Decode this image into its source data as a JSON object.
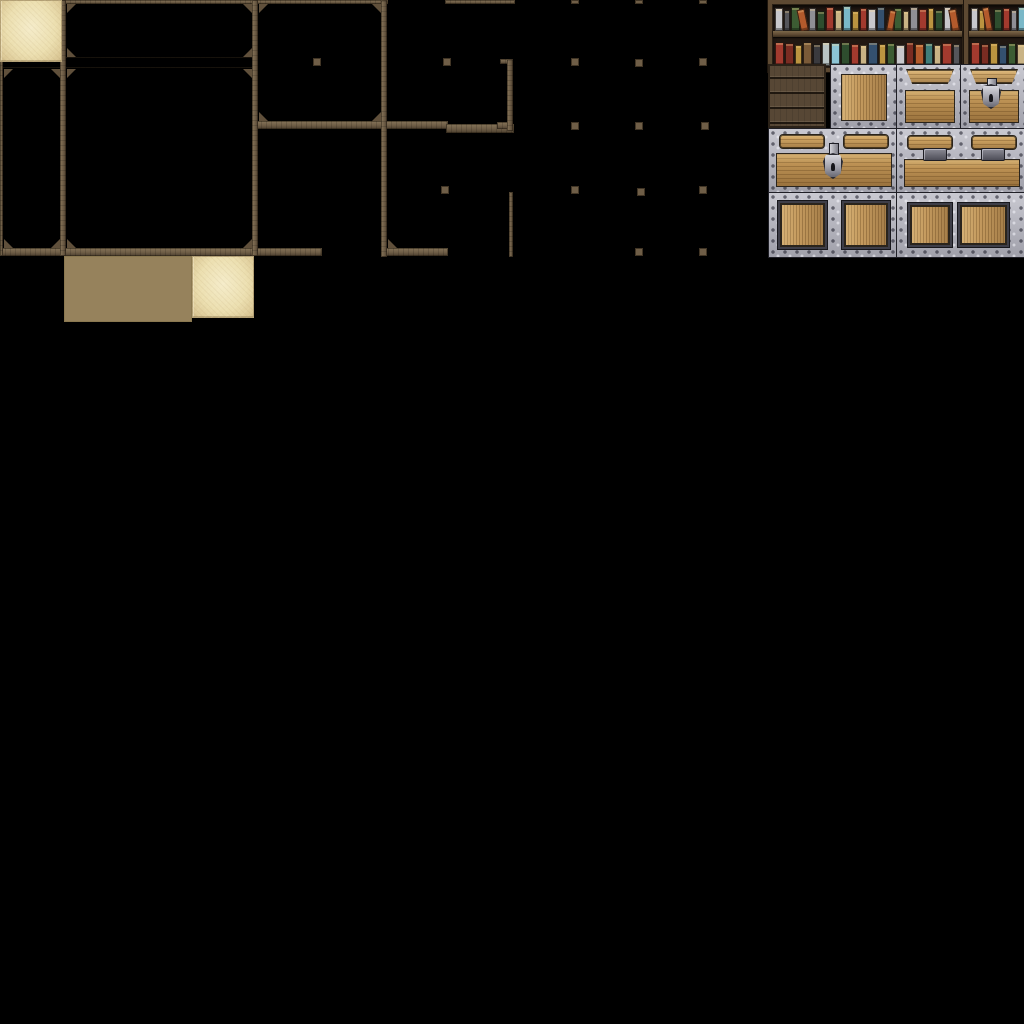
{
  "meta": {
    "asset_type": "rpg-interior-tileset-spritesheet",
    "canvas": {
      "width": 1024,
      "height": 1024,
      "background": "#000000"
    },
    "tile_size": 64,
    "sections": [
      "wood-wall-frames",
      "floor-tiles",
      "furniture-sprites"
    ]
  },
  "palette": {
    "beam_wood": "#6f5e47",
    "beam_wood_light": "#87755a",
    "beam_wood_dark": "#4c3f2f",
    "sand_floor": "#ecdfb0",
    "sand_light": "#f5ecca",
    "sand_shadow": "#ccb786",
    "cobble_stone": "#ecdfae",
    "cobble_grout": "#96825c",
    "shelf_frame": "#5d4932",
    "shelf_backdrop": "#211812",
    "metal_silver": "#b2b2ba",
    "metal_dark": "#3e3e48",
    "metal_outline": "#1f1f26",
    "chest_wood": "#bd9254",
    "chest_wood_light": "#d4ad72",
    "crate_dark_wood": "#574735"
  },
  "tiles_catalog": [
    {
      "name": "wall-frame-cell-small",
      "x": 0,
      "y": 0,
      "w": 64,
      "h": 64
    },
    {
      "name": "wall-frame-cell-wide",
      "x": 64,
      "y": 0,
      "w": 192,
      "h": 64
    },
    {
      "name": "wall-frame-cell-tall",
      "x": 256,
      "y": 0,
      "w": 128,
      "h": 128
    },
    {
      "name": "wall-frame-cell-room",
      "x": 0,
      "y": 64,
      "w": 256,
      "h": 192
    },
    {
      "name": "wall-post-knobs",
      "x": 512,
      "y": 0,
      "w": 256,
      "h": 256
    },
    {
      "name": "sand-floor",
      "x": 0,
      "y": 256,
      "w": 64,
      "h": 64
    },
    {
      "name": "cobblestone-floor",
      "x": 64,
      "y": 256,
      "w": 128,
      "h": 64
    },
    {
      "name": "sand-floor-2",
      "x": 192,
      "y": 256,
      "w": 64,
      "h": 64
    },
    {
      "name": "bookshelf-wide",
      "x": 768,
      "y": 0,
      "w": 192,
      "h": 64
    },
    {
      "name": "bookshelf-small",
      "x": 960,
      "y": 0,
      "w": 64,
      "h": 64
    },
    {
      "name": "dark-plank-crate",
      "x": 768,
      "y": 64,
      "w": 64,
      "h": 64
    },
    {
      "name": "ornate-metal-crate",
      "x": 832,
      "y": 64,
      "w": 64,
      "h": 64
    },
    {
      "name": "chest-top-plain",
      "x": 896,
      "y": 64,
      "w": 64,
      "h": 64
    },
    {
      "name": "chest-top-lock",
      "x": 960,
      "y": 64,
      "w": 64,
      "h": 64
    },
    {
      "name": "chest-front-lock",
      "x": 768,
      "y": 128,
      "w": 128,
      "h": 64
    },
    {
      "name": "chest-front-hinges",
      "x": 896,
      "y": 128,
      "w": 128,
      "h": 64
    },
    {
      "name": "chest-base-panels-a",
      "x": 768,
      "y": 192,
      "w": 128,
      "h": 64
    },
    {
      "name": "chest-base-panels-b",
      "x": 896,
      "y": 192,
      "w": 128,
      "h": 64
    }
  ],
  "wall_frame": {
    "beams": [
      [
        0,
        0,
        388,
        4,
        "h"
      ],
      [
        445,
        0,
        70,
        4,
        "h"
      ],
      [
        0,
        57,
        256,
        11,
        "shelf"
      ],
      [
        256,
        121,
        192,
        8,
        "h"
      ],
      [
        446,
        124,
        68,
        9,
        "h"
      ],
      [
        0,
        248,
        322,
        8,
        "h"
      ],
      [
        383,
        248,
        65,
        8,
        "h"
      ],
      [
        500,
        59,
        9,
        5,
        "h"
      ],
      [
        497,
        122,
        12,
        7,
        "h"
      ],
      [
        0,
        0,
        3,
        256,
        "v"
      ],
      [
        60,
        0,
        6,
        256,
        "v"
      ],
      [
        252,
        0,
        6,
        256,
        "v"
      ],
      [
        381,
        0,
        6,
        257,
        "v"
      ],
      [
        507,
        59,
        6,
        72,
        "v"
      ],
      [
        509,
        192,
        4,
        65,
        "v"
      ]
    ],
    "brackets": [
      [
        4,
        4,
        "tl"
      ],
      [
        51,
        4,
        "tr"
      ],
      [
        4,
        48,
        "bl"
      ],
      [
        51,
        48,
        "br"
      ],
      [
        67,
        4,
        "tl"
      ],
      [
        243,
        4,
        "tr"
      ],
      [
        67,
        48,
        "bl"
      ],
      [
        243,
        48,
        "br"
      ],
      [
        259,
        4,
        "tl"
      ],
      [
        372,
        4,
        "tr"
      ],
      [
        259,
        112,
        "bl"
      ],
      [
        372,
        112,
        "br"
      ],
      [
        4,
        69,
        "tl"
      ],
      [
        51,
        69,
        "tr"
      ],
      [
        4,
        239,
        "bl"
      ],
      [
        51,
        239,
        "br"
      ],
      [
        67,
        69,
        "tl"
      ],
      [
        243,
        69,
        "tr"
      ],
      [
        67,
        239,
        "bl"
      ],
      [
        243,
        239,
        "br"
      ],
      [
        388,
        239,
        "bl"
      ]
    ],
    "knobs": [
      [
        571,
        0,
        8,
        4
      ],
      [
        635,
        0,
        8,
        4
      ],
      [
        699,
        0,
        8,
        4
      ],
      [
        313,
        58,
        8,
        8
      ],
      [
        443,
        58,
        8,
        8
      ],
      [
        571,
        58,
        8,
        8
      ],
      [
        635,
        59,
        8,
        8
      ],
      [
        699,
        58,
        8,
        8
      ],
      [
        571,
        122,
        8,
        8
      ],
      [
        635,
        122,
        8,
        8
      ],
      [
        701,
        122,
        8,
        8
      ],
      [
        441,
        186,
        8,
        8
      ],
      [
        571,
        186,
        8,
        8
      ],
      [
        637,
        188,
        8,
        8
      ],
      [
        699,
        186,
        8,
        8
      ],
      [
        635,
        248,
        8,
        8
      ],
      [
        699,
        248,
        8,
        8
      ]
    ]
  },
  "furniture": {
    "books": {
      "wide-top": [
        {
          "c": "#c8c8cc",
          "h": 21,
          "w": 7
        },
        {
          "c": "#55555a",
          "h": 19,
          "w": 6
        },
        {
          "c": "#3c5c33",
          "h": 22,
          "w": 8
        },
        {
          "c": "#b35a2c",
          "h": 20,
          "w": 7,
          "r": -12
        },
        {
          "c": "#8f8f95",
          "h": 21,
          "w": 6
        },
        {
          "c": "#2e4d2e",
          "h": 18,
          "w": 7
        },
        {
          "c": "#a23a2e",
          "h": 22,
          "w": 8
        },
        {
          "c": "#c9b385",
          "h": 19,
          "w": 6
        },
        {
          "c": "#7ab8c8",
          "h": 23,
          "w": 8
        },
        {
          "c": "#bb9440",
          "h": 18,
          "w": 6
        },
        {
          "c": "#a23a2e",
          "h": 21,
          "w": 7
        },
        {
          "c": "#c8c8cc",
          "h": 20,
          "w": 7
        },
        {
          "c": "#34506e",
          "h": 22,
          "w": 8
        },
        {
          "c": "#b35a2c",
          "h": 19,
          "w": 6,
          "r": 10
        },
        {
          "c": "#3c5c33",
          "h": 21,
          "w": 7
        },
        {
          "c": "#c9b385",
          "h": 18,
          "w": 6
        },
        {
          "c": "#8f8f95",
          "h": 22,
          "w": 7
        },
        {
          "c": "#a23a2e",
          "h": 20,
          "w": 7
        },
        {
          "c": "#bb9440",
          "h": 21,
          "w": 6
        },
        {
          "c": "#2e4d2e",
          "h": 19,
          "w": 7
        },
        {
          "c": "#c8c8cc",
          "h": 22,
          "w": 7
        },
        {
          "c": "#b35a2c",
          "h": 20,
          "w": 7,
          "r": -10
        }
      ],
      "wide-bottom": [
        {
          "c": "#a23a2e",
          "h": 22,
          "w": 8
        },
        {
          "c": "#7a2c22",
          "h": 21,
          "w": 7
        },
        {
          "c": "#bb9440",
          "h": 19,
          "w": 6
        },
        {
          "c": "#7a5a38",
          "h": 22,
          "w": 8
        },
        {
          "c": "#3a3a3e",
          "h": 20,
          "w": 6
        },
        {
          "c": "#b9c4c4",
          "h": 22,
          "w": 7
        },
        {
          "c": "#8cc4d4",
          "h": 21,
          "w": 8
        },
        {
          "c": "#2e4d2e",
          "h": 22,
          "w": 7
        },
        {
          "c": "#a23a2e",
          "h": 20,
          "w": 7
        },
        {
          "c": "#c9b385",
          "h": 19,
          "w": 6
        },
        {
          "c": "#34506e",
          "h": 22,
          "w": 8
        },
        {
          "c": "#bb9440",
          "h": 20,
          "w": 6
        },
        {
          "c": "#3c5c33",
          "h": 21,
          "w": 7
        },
        {
          "c": "#c8c8cc",
          "h": 19,
          "w": 7
        },
        {
          "c": "#7a2c22",
          "h": 22,
          "w": 7
        },
        {
          "c": "#b35a2c",
          "h": 20,
          "w": 7
        },
        {
          "c": "#3f7d7a",
          "h": 21,
          "w": 7
        },
        {
          "c": "#c9b385",
          "h": 19,
          "w": 6
        },
        {
          "c": "#a23a2e",
          "h": 21,
          "w": 8
        },
        {
          "c": "#55555a",
          "h": 20,
          "w": 6
        }
      ],
      "small-top": [
        {
          "c": "#c8c8cc",
          "h": 21,
          "w": 7
        },
        {
          "c": "#bb9440",
          "h": 19,
          "w": 6
        },
        {
          "c": "#b35a2c",
          "h": 22,
          "w": 7,
          "r": -10
        },
        {
          "c": "#2e4d2e",
          "h": 20,
          "w": 7
        },
        {
          "c": "#a23a2e",
          "h": 21,
          "w": 7
        },
        {
          "c": "#8f8f95",
          "h": 19,
          "w": 6
        },
        {
          "c": "#7ab8c8",
          "h": 22,
          "w": 7
        }
      ],
      "small-bottom": [
        {
          "c": "#a23a2e",
          "h": 22,
          "w": 8
        },
        {
          "c": "#7a2c22",
          "h": 20,
          "w": 7
        },
        {
          "c": "#bb9440",
          "h": 21,
          "w": 7
        },
        {
          "c": "#34506e",
          "h": 19,
          "w": 7
        },
        {
          "c": "#3c5c33",
          "h": 21,
          "w": 7
        },
        {
          "c": "#c9b385",
          "h": 20,
          "w": 7
        }
      ]
    }
  }
}
